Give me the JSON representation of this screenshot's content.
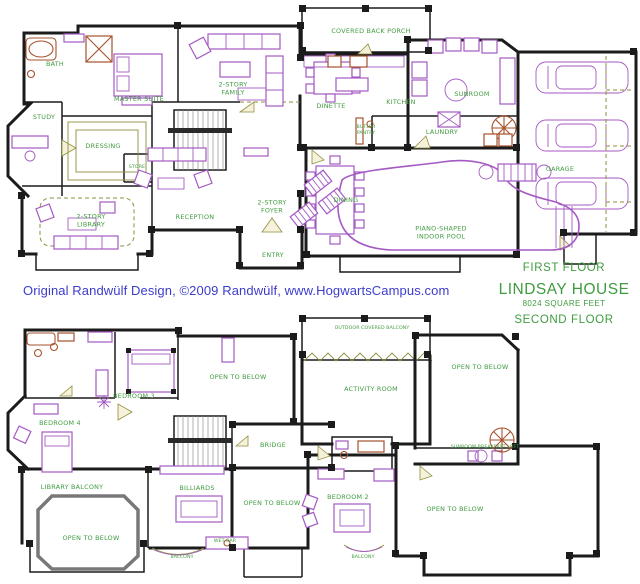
{
  "credit_line": "Original Randwülf Design, ©2009 Randwülf, www.HogwartsCampus.com",
  "title_block": {
    "first_floor_caption": "FIRST FLOOR",
    "house_name": "LINDSAY HOUSE",
    "area": "8024 SQUARE FEET",
    "second_floor_caption": "SECOND FLOOR"
  },
  "colors": {
    "label_green": "#3f9b3f",
    "credit_blue": "#3c3ccc",
    "wall_black": "#1b1b1b",
    "furniture_purple": "#a45ac2",
    "fixture_rust": "#a5512d",
    "door_olive": "#8f8f3e"
  },
  "floors": [
    {
      "name": "First Floor",
      "rooms": [
        {
          "label": "BATH",
          "x": 55,
          "y": 64
        },
        {
          "label": "MASTER SUITE",
          "x": 139,
          "y": 99
        },
        {
          "label": "2-STORY\nFAMILY",
          "x": 233,
          "y": 89
        },
        {
          "label": "STUDY",
          "x": 44,
          "y": 117
        },
        {
          "label": "DRESSING",
          "x": 103,
          "y": 146
        },
        {
          "label": "STORE",
          "x": 137,
          "y": 168,
          "size": "tiny"
        },
        {
          "label": "2-STORY\nLIBRARY",
          "x": 91,
          "y": 221
        },
        {
          "label": "RECEPTION",
          "x": 195,
          "y": 217
        },
        {
          "label": "2-STORY\nFOYER",
          "x": 272,
          "y": 207
        },
        {
          "label": "ENTRY",
          "x": 273,
          "y": 255
        },
        {
          "label": "COVERED BACK PORCH",
          "x": 371,
          "y": 31
        },
        {
          "label": "DINETTE",
          "x": 331,
          "y": 106
        },
        {
          "label": "KITCHEN",
          "x": 401,
          "y": 102
        },
        {
          "label": "SUNROOM",
          "x": 472,
          "y": 94
        },
        {
          "label": "BUTLER\nPANTRY",
          "x": 366,
          "y": 131,
          "size": "tiny"
        },
        {
          "label": "LAUNDRY",
          "x": 442,
          "y": 132
        },
        {
          "label": "DINING",
          "x": 346,
          "y": 200
        },
        {
          "label": "PIANO-SHAPED\nINDOOR POOL",
          "x": 441,
          "y": 233
        },
        {
          "label": "GARAGE",
          "x": 560,
          "y": 169
        }
      ]
    },
    {
      "name": "Second Floor",
      "rooms": [
        {
          "label": "OUTDOOR COVERED BALCONY",
          "x": 372,
          "y": 329,
          "size": "tiny"
        },
        {
          "label": "OPEN TO BELOW",
          "x": 238,
          "y": 377
        },
        {
          "label": "BEDROOM 3",
          "x": 134,
          "y": 396
        },
        {
          "label": "BEDROOM 4",
          "x": 60,
          "y": 423
        },
        {
          "label": "ACTIVITY ROOM",
          "x": 371,
          "y": 389
        },
        {
          "label": "OPEN TO BELOW",
          "x": 480,
          "y": 367
        },
        {
          "label": "SUNROOM BREAKFAST LOFT",
          "x": 485,
          "y": 448,
          "size": "tiny"
        },
        {
          "label": "BRIDGE",
          "x": 273,
          "y": 445
        },
        {
          "label": "LIBRARY BALCONY",
          "x": 72,
          "y": 487
        },
        {
          "label": "BILLIARDS",
          "x": 197,
          "y": 488
        },
        {
          "label": "OPEN TO BELOW",
          "x": 91,
          "y": 538
        },
        {
          "label": "OPEN TO BELOW",
          "x": 272,
          "y": 503
        },
        {
          "label": "WET BAR",
          "x": 225,
          "y": 542,
          "size": "tiny"
        },
        {
          "label": "BALCONY",
          "x": 182,
          "y": 558,
          "size": "tiny"
        },
        {
          "label": "BEDROOM 2",
          "x": 348,
          "y": 497
        },
        {
          "label": "OPEN TO BELOW",
          "x": 455,
          "y": 509
        },
        {
          "label": "BALCONY",
          "x": 363,
          "y": 558,
          "size": "tiny"
        }
      ]
    }
  ]
}
